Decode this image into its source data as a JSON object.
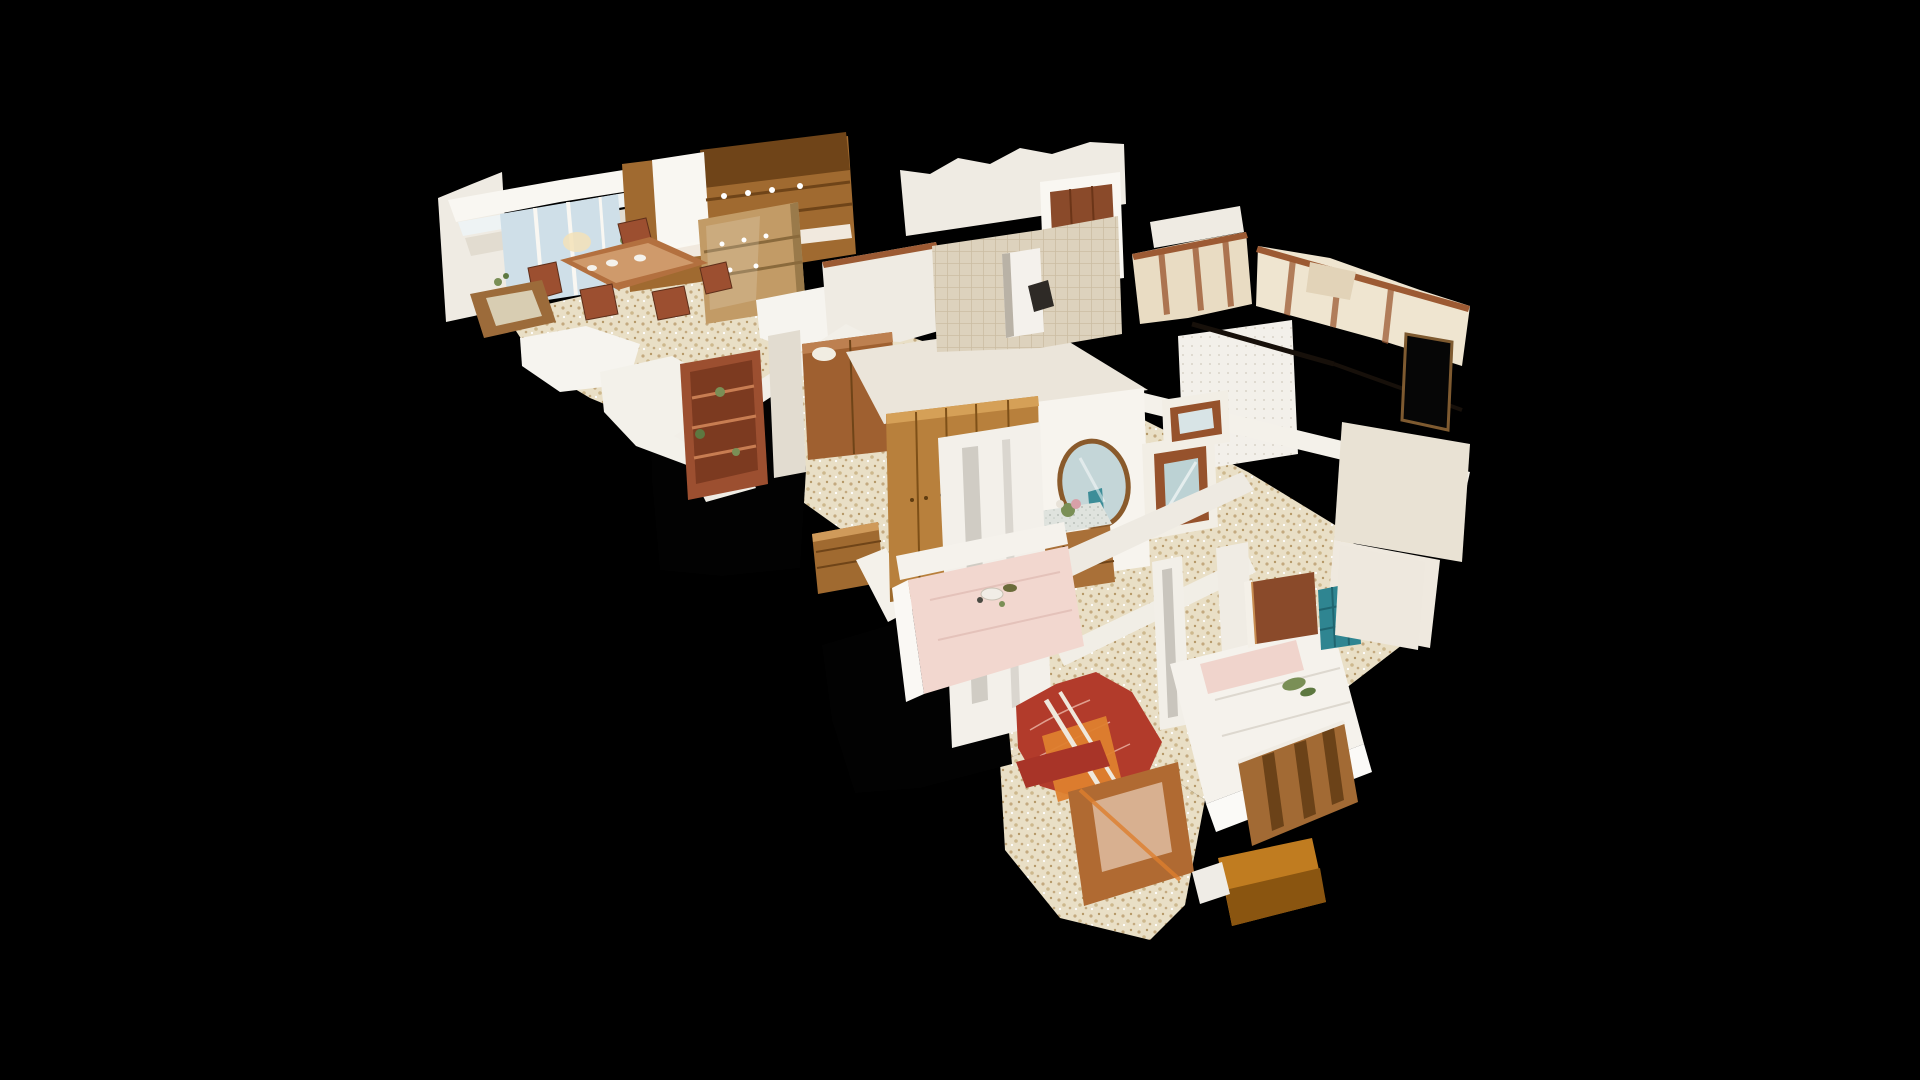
{
  "viewer": {
    "aria_label": "3D dollhouse cutaway view of a scanned apartment floating on a black background",
    "view_mode": "dollhouse",
    "background": "#000000"
  },
  "palette": {
    "bg": "#000000",
    "hole-black": "#020202",
    "wall-white": "#efebe3",
    "wall-bright": "#f9f7f2",
    "wall-dim": "#e2dcd0",
    "wall-shadow": "#cfc8ba",
    "wall-warm": "#e9dcc3",
    "wall-tile": "#ddd2bd",
    "ceiling": "#ebe5da",
    "cut-edge": "#9c5a33",
    "wood-light": "#b8803c",
    "wood-mid": "#a06a30",
    "wood-dark": "#6f4418",
    "wood-red": "#9c4f30",
    "door-wood": "#8a4a2a",
    "floor-base": "#e9dfc6",
    "floor-speck1": "#c3a97f",
    "floor-speck2": "#a8residue",
    "window-light": "#eef3f4",
    "window-sky": "#cfdfe8",
    "teal": "#2f8591",
    "teal-dark": "#1f6570",
    "pink": "#f2d7cf",
    "red-chair": "#b23b2b",
    "chair-pattern": "#e8b0a0",
    "orange": "#de7f2e",
    "bed-white": "#f5f2ec",
    "marble": "#dfe3de",
    "mirror-glass": "#c4d6d8",
    "mirror-rim": "#8a5a2b",
    "plant-green": "#7a8f56",
    "rod-dark": "#17100a"
  },
  "scene": {
    "model_type": "dollhouse-3d-scan",
    "rooms": [
      {
        "id": "living-dining-room",
        "contents": "window wall, dining table with chairs, kitchen cabinets, china hutch, coffee table"
      },
      {
        "id": "middle-hallway",
        "contents": "red bookshelf, armoire, small dresser, scan holes"
      },
      {
        "id": "bathroom-corridor",
        "contents": "tiled wall, red-brown door, doorway opening"
      },
      {
        "id": "right-wing",
        "contents": "torn tan wall planes, curtain rod, dark window opening"
      },
      {
        "id": "entry-hallway",
        "contents": "oval mirror, console dresser with flowers, golden oak wardrobe, glazed wooden door"
      },
      {
        "id": "bedroom-pink",
        "contents": "pink bedspread with breakfast tray, red patterned armchair, orange-trim dressing table"
      },
      {
        "id": "bedroom-white",
        "contents": "white double bed with pink pillows, wooden headboard, door with teal tiled bathroom glimpse, wooden bench"
      }
    ]
  }
}
